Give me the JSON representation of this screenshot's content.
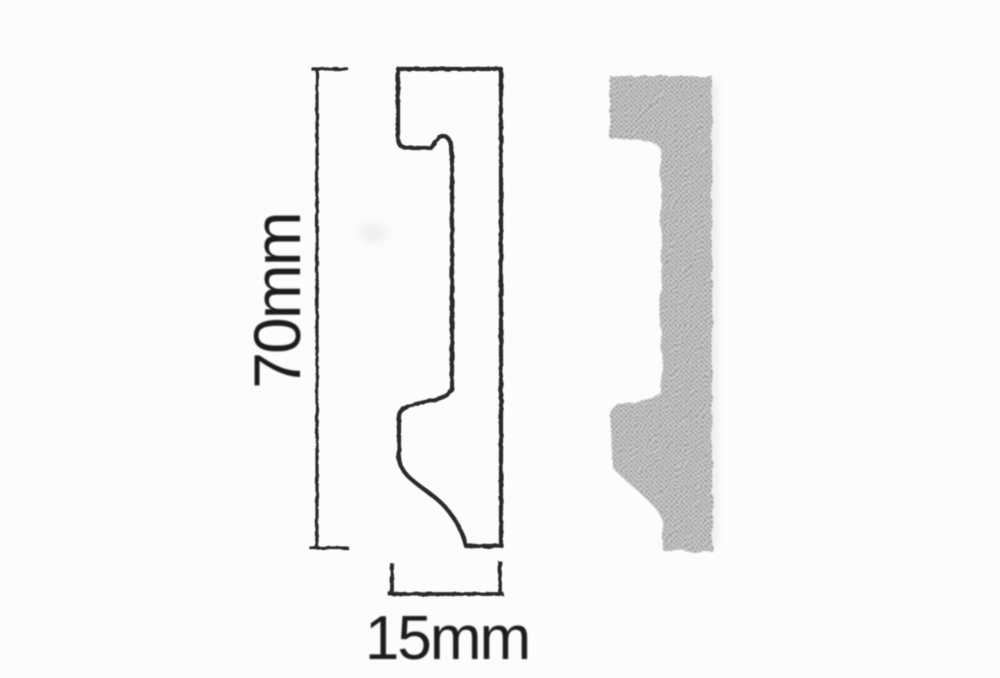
{
  "diagram": {
    "type": "technical-profile-drawing",
    "dimensions": {
      "height_label": "70mm",
      "width_label": "15mm"
    },
    "views": {
      "left": "outline cross-section with dimension brackets",
      "right": "halftone filled cross-section"
    },
    "colors": {
      "background": "#fcfcfc",
      "line": "#2a2a2a",
      "text": "#1e1e1e",
      "fill_dark": "#9c9c9c",
      "fill_mid": "#a8a8a8",
      "fill_light": "#cccccc"
    }
  }
}
